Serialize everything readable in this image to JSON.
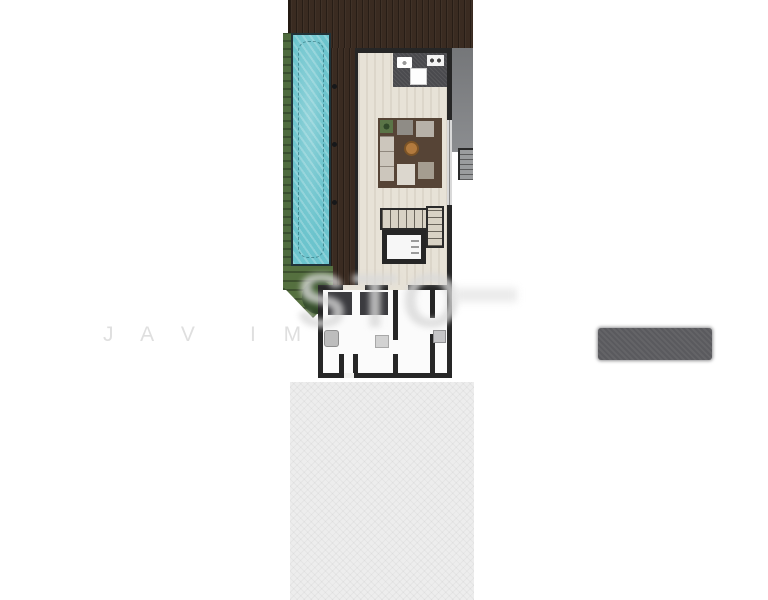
{
  "canvas": {
    "width": 768,
    "height": 600,
    "background": "#ffffff"
  },
  "watermark": {
    "row_left": "J A V",
    "row_right": "I M",
    "large": "STO",
    "row_color": "#dfdfdf",
    "large_color": "#d8d8d8"
  },
  "plan": {
    "wall_color": "#262626",
    "areas": [
      {
        "id": "sun-deck",
        "label": "sun deck",
        "color": "#3a2b21"
      },
      {
        "id": "pool",
        "label": "lap pool",
        "color": "#6cc4cd"
      },
      {
        "id": "garden-strip",
        "label": "garden strip",
        "color": "#4e6b3d"
      },
      {
        "id": "garden-lower",
        "label": "lower garden",
        "color": "#55703f"
      },
      {
        "id": "living-room",
        "label": "living room",
        "color": "#e7e2d7"
      },
      {
        "id": "kitchen",
        "label": "kitchen counter",
        "color": "#4a4a4e"
      },
      {
        "id": "rug",
        "label": "living room rug",
        "color": "#564436"
      },
      {
        "id": "coffee-table",
        "label": "round coffee table",
        "color": "#b27a3e"
      },
      {
        "id": "staircase",
        "label": "staircase",
        "color": "#d8d2c5"
      },
      {
        "id": "elevator",
        "label": "elevator",
        "color": "#f7f7f7"
      },
      {
        "id": "bathroom",
        "label": "bathroom",
        "color": "#fbfbfb"
      },
      {
        "id": "hall",
        "label": "hall",
        "color": "#fbfbfb"
      },
      {
        "id": "laundry",
        "label": "laundry room",
        "color": "#fbfbfb"
      },
      {
        "id": "side-terrace",
        "label": "side terrace",
        "color": "#85878a"
      },
      {
        "id": "exterior-stairs",
        "label": "exterior stairs",
        "color": "#9a9c9e"
      },
      {
        "id": "patio",
        "label": "patio",
        "color": "#ededed"
      }
    ]
  },
  "redacted_label": {
    "color": "#5a5a5e"
  }
}
